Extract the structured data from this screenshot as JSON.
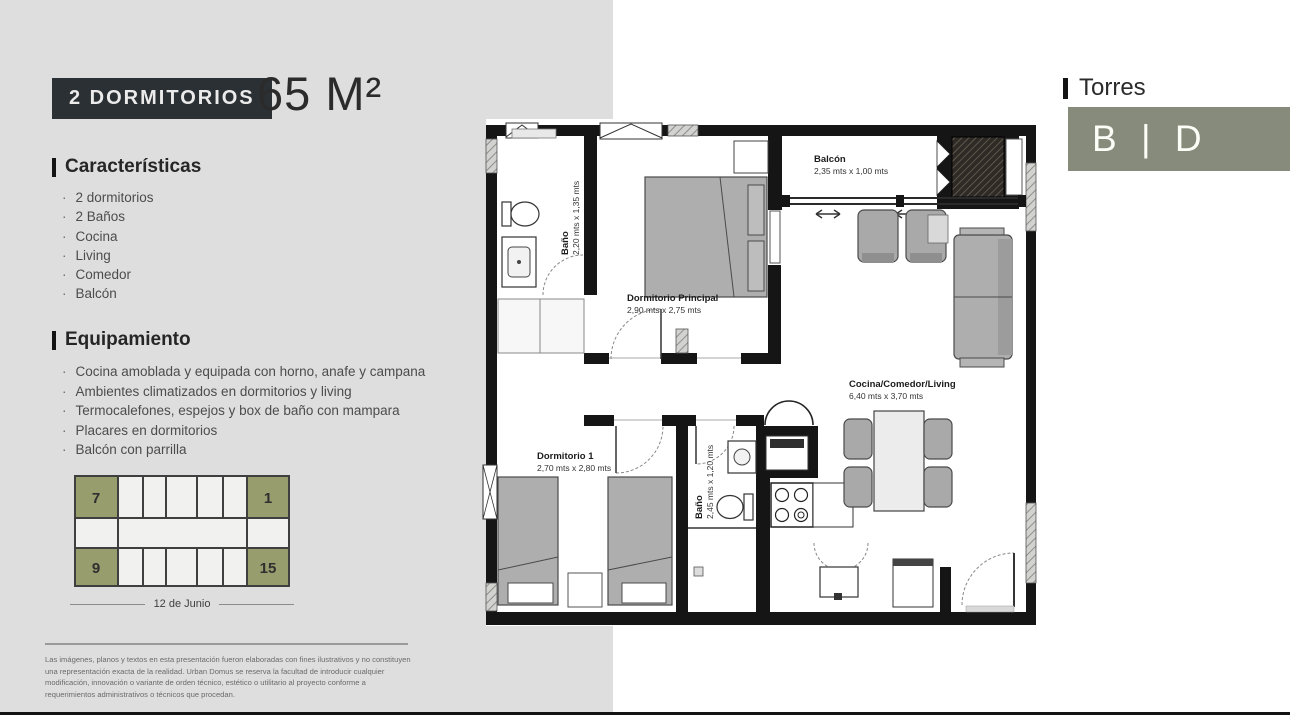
{
  "header": {
    "badge": "2 DORMITORIOS",
    "area": "65 M²"
  },
  "caracteristicas": {
    "title": "Características",
    "items": [
      "2 dormitorios",
      "2 Baños",
      "Cocina",
      "Living",
      "Comedor",
      "Balcón"
    ]
  },
  "equipamiento": {
    "title": "Equipamiento",
    "items": [
      "Cocina amoblada y equipada con horno, anafe y campana",
      "Ambientes climatizados en dormitorios y living",
      "Termocalefones, espejos y box de baño con mampara",
      "Placares en dormitorios",
      "Balcón con parrilla"
    ]
  },
  "building": {
    "units": [
      "7",
      "1",
      "9",
      "15"
    ],
    "street": "12 de Junio"
  },
  "floorplan": {
    "rooms": [
      {
        "name": "Baño",
        "dims": "2,20 mts x 1,35 mts"
      },
      {
        "name": "Dormitorio Principal",
        "dims": "2,90 mts x 2,75 mts"
      },
      {
        "name": "Balcón",
        "dims": "2,35 mts x 1,00 mts"
      },
      {
        "name": "Cocina/Comedor/Living",
        "dims": "6,40 mts x 3,70 mts"
      },
      {
        "name": "Dormitorio 1",
        "dims": "2,70 mts x 2,80 mts"
      },
      {
        "name": "Baño",
        "dims": "2,45 mts x 1,20 mts"
      }
    ]
  },
  "torres": {
    "title": "Torres",
    "logo": "B | D"
  },
  "disclaimer": "Las imágenes, planos y textos en esta presentación fueron elaboradas con fines ilustrativos y no constituyen una representación exacta de la realidad. Urban Domus se reserva la facultad de introducir cualquier modificación, innovación o variante de orden técnico, estético o utilitario al proyecto conforme a requerimientos administrativos o técnicos que procedan.",
  "colors": {
    "olive": "#979d6c",
    "logo_box": "#868b7b",
    "badge_bg": "#2b3034",
    "bg_left": "#dedede",
    "wall": "#151515"
  }
}
